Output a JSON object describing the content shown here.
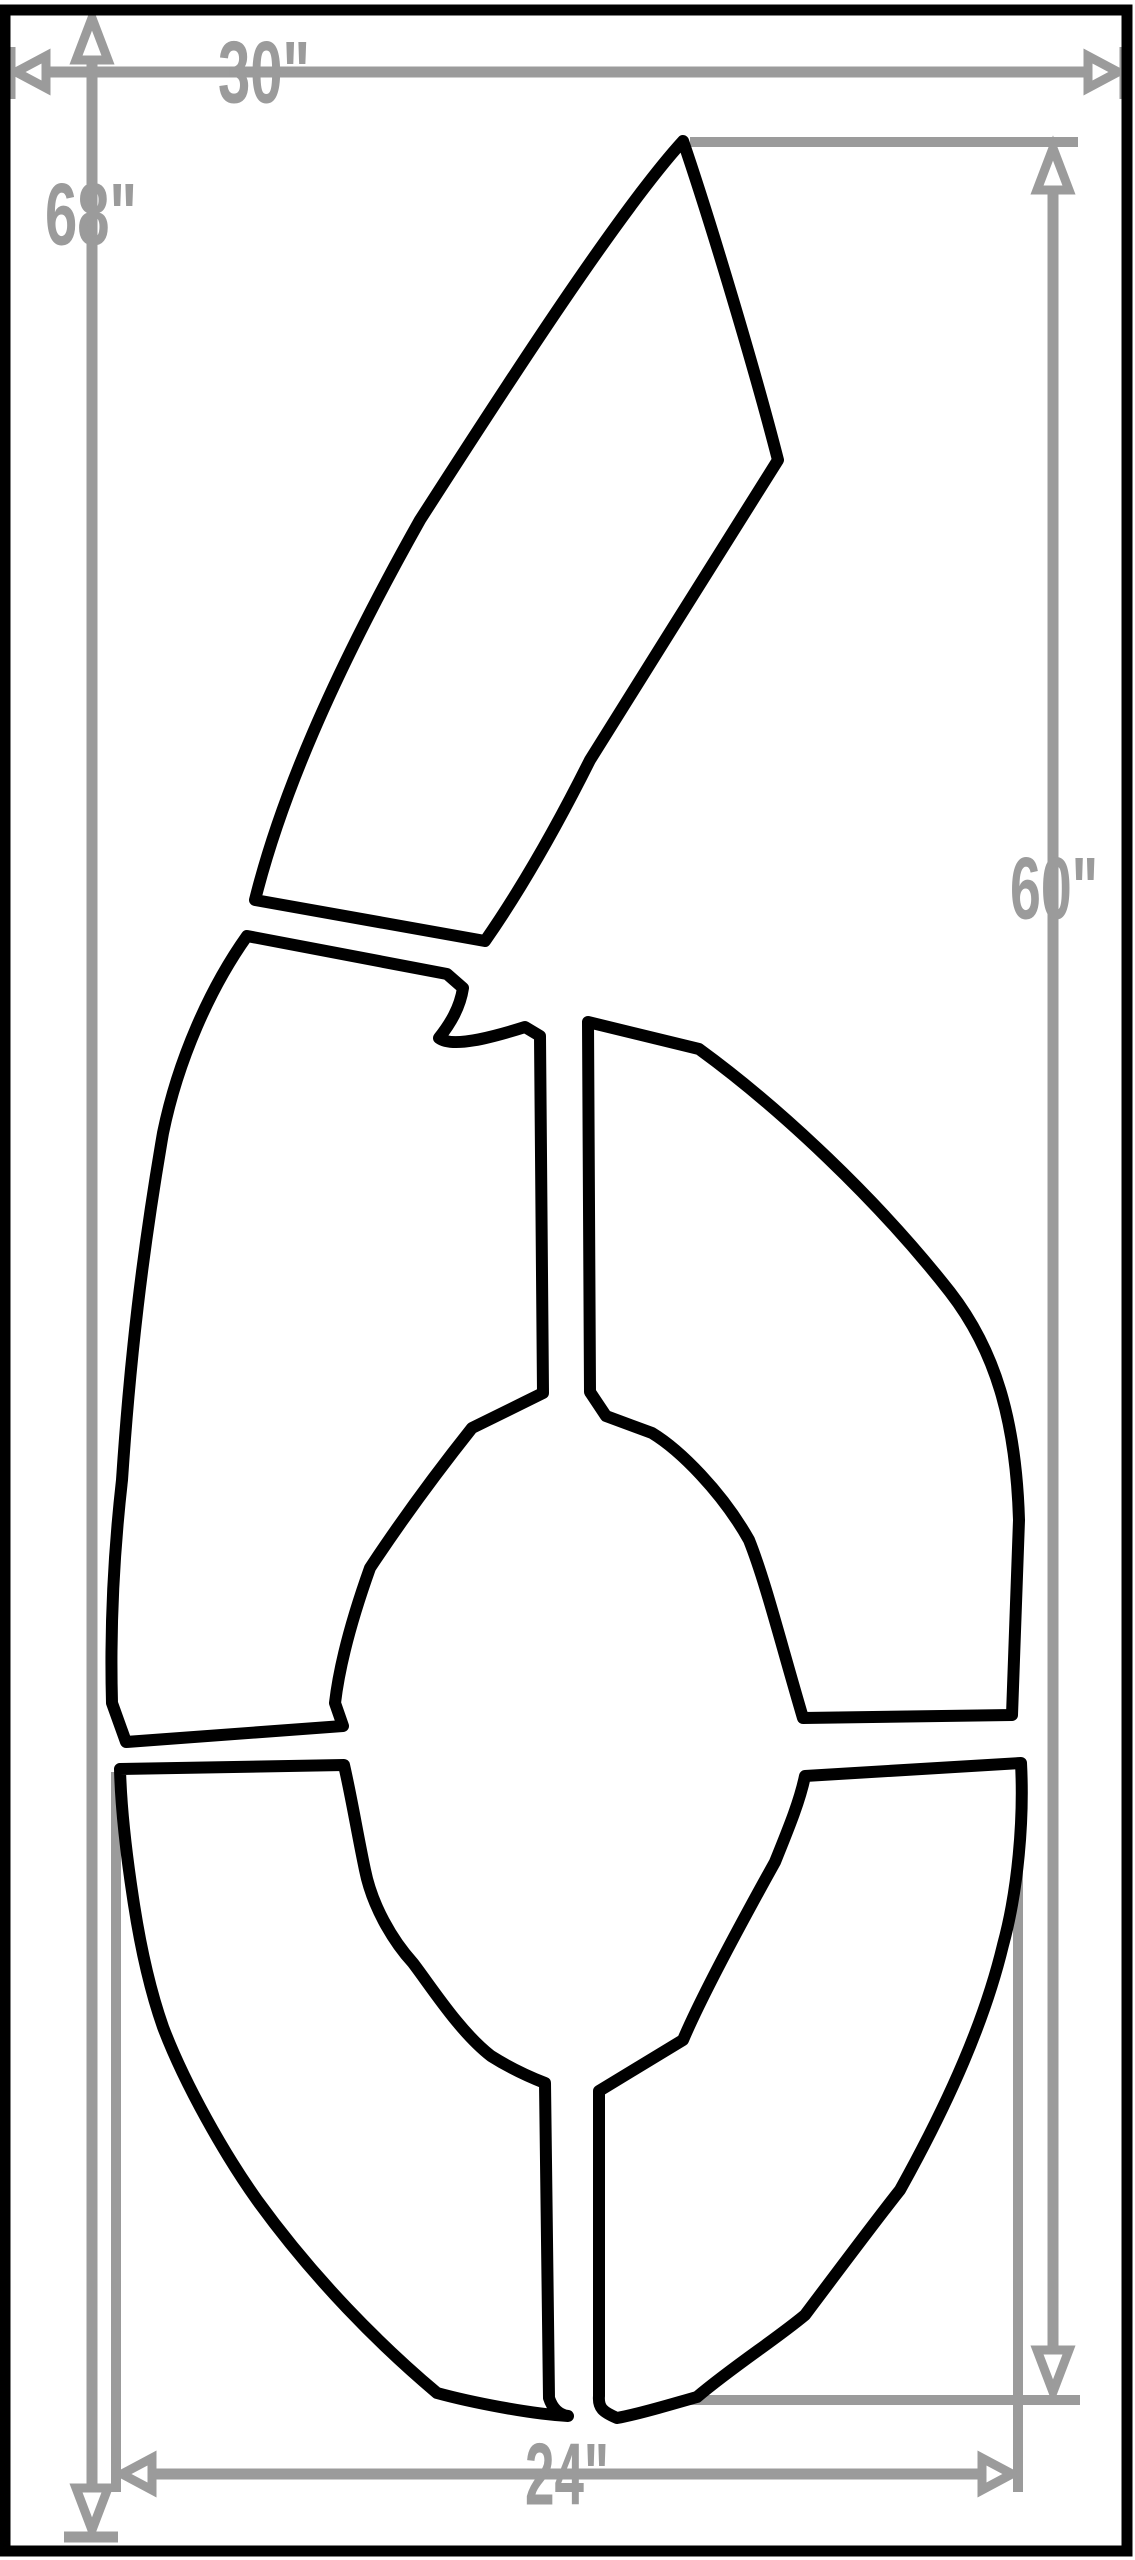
{
  "diagram": {
    "type": "stencil-dimension-drawing",
    "digit": "6",
    "colors": {
      "outline": "#000000",
      "dimension": "#9b9b9b",
      "background": "#ffffff"
    },
    "dimensions": {
      "overall_width": {
        "label": "30\""
      },
      "overall_height": {
        "label": "68\""
      },
      "digit_height": {
        "label": "60\""
      },
      "digit_width": {
        "label": "24\""
      }
    }
  }
}
